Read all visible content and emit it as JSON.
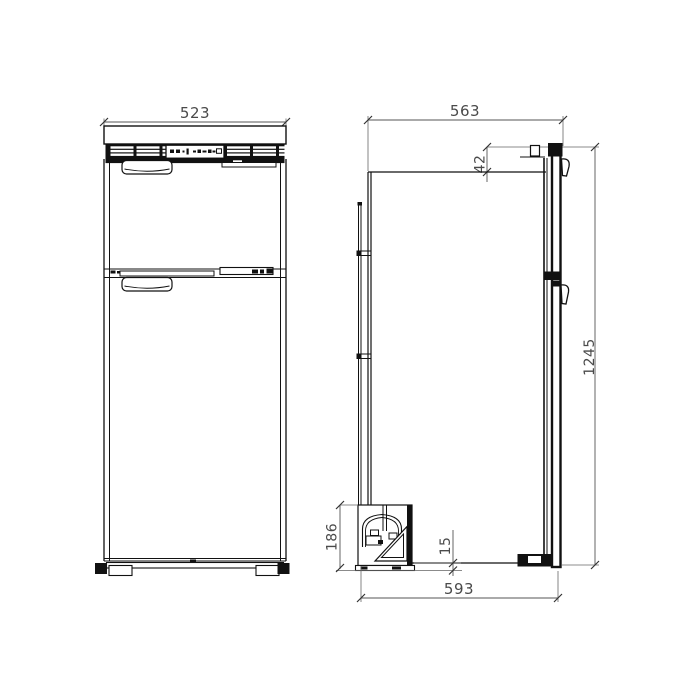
{
  "drawing": {
    "type": "technical-dimension-drawing",
    "views": {
      "front_label": "front-elevation",
      "side_label": "side-elevation"
    },
    "colors": {
      "line": "#111111",
      "dimension_text": "#4a4a4a",
      "background": "#ffffff"
    },
    "dimensions": {
      "front_width": "523",
      "side_depth": "563",
      "door_top_offset": "42",
      "overall_height": "1245",
      "compressor_unit_height": "186",
      "bottom_clearance": "15",
      "overall_depth": "593"
    }
  }
}
